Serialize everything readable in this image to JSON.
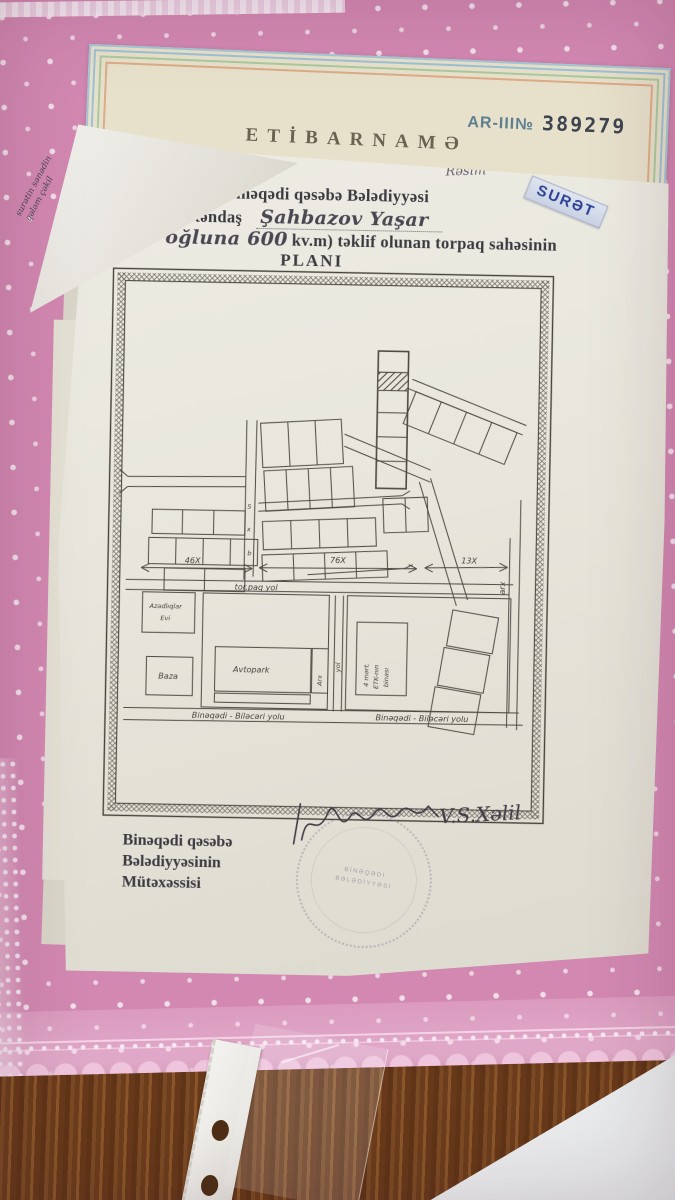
{
  "certificate": {
    "series": "AR-III№",
    "number": "389279",
    "title": "ETİBARNAMƏ"
  },
  "side_note": {
    "line1": "surətin sənədin",
    "line2": "qələm çəkil"
  },
  "document": {
    "corner_note": "Rəsim",
    "copy_stamp": "SURƏT",
    "header": {
      "line1": "Binəqədi rayonu Binəqədi qəsəbə Bələdiyyəsi",
      "line2_printed": "tərəfindən   vətəndaş",
      "name_handwritten": "Şahbazov  Yaşar",
      "line3_handwritten": "Heydər oğluna 600",
      "line3_printed": "kv.m) təklif olunan  torpaq  sahəsinin",
      "title": "PLANI"
    },
    "footer": {
      "line1": "Binəqədi  qəsəbə",
      "line2": "Bələdiyyəsinin",
      "line3": "Mütəxəssisi"
    },
    "signature": "V.S.Xəlil",
    "seal": {
      "line1": "BİNƏQƏDİ",
      "line2": "BƏLƏDİYYƏSİ"
    }
  },
  "plan": {
    "measurements": [
      "46X",
      "76X",
      "13X"
    ],
    "top_road": "tor.paq  yol",
    "bottom_road_left": "Binəqədi - Biləcəri  yolu",
    "bottom_road_right": "Binəqədi - Biləcəri  yolu",
    "utility_line1": "Azadlıqlar",
    "utility_line2": "Evi",
    "baza": "Baza",
    "avtopark": "Avtopark",
    "strip_label": "Arx",
    "mid_road": "yol",
    "etk_line1": "4 mərt.",
    "etk_line2": "ETK-nın",
    "etk_line3": "binası",
    "right_edge": "arx",
    "marks": [
      "5",
      "x",
      "b"
    ]
  }
}
